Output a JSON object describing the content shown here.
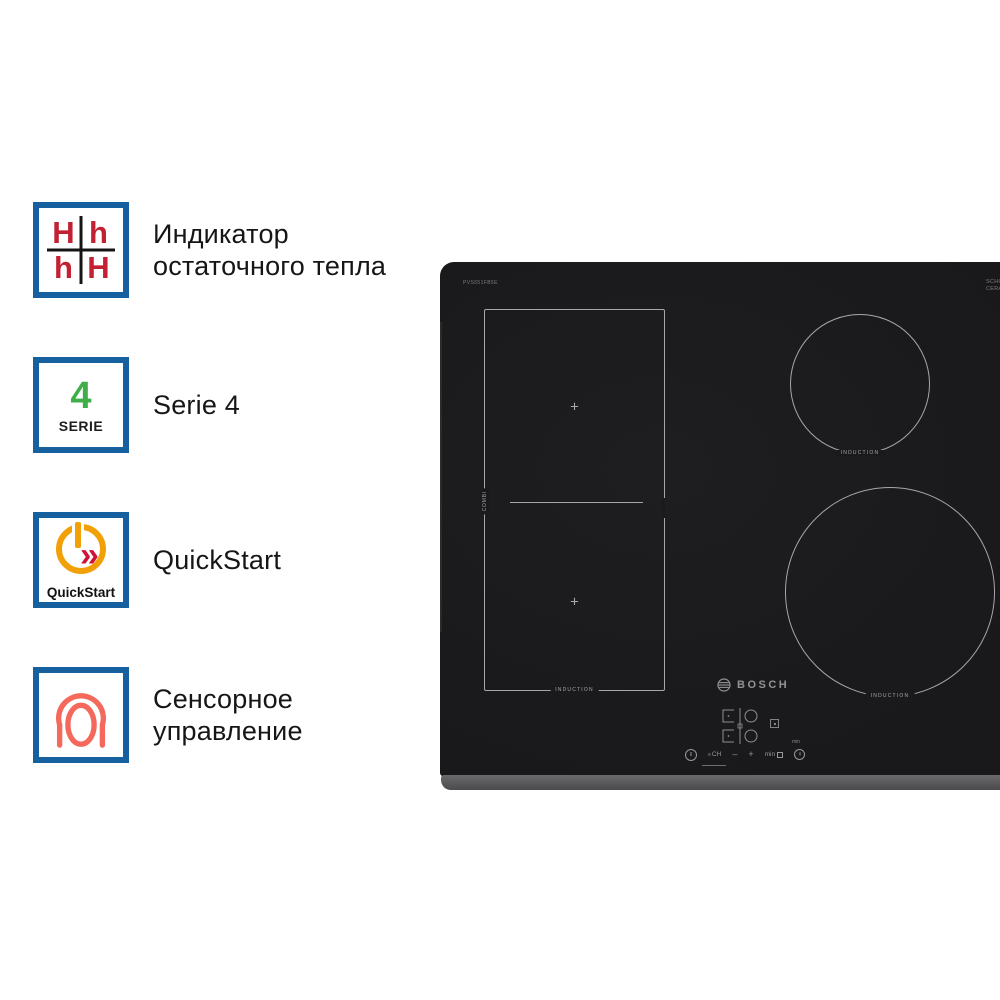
{
  "features": [
    {
      "name": "residual-heat-indicator",
      "icon": {
        "letters": [
          "H",
          "h",
          "h",
          "H"
        ]
      },
      "lines": [
        "Индикатор",
        "остаточного тепла"
      ]
    },
    {
      "name": "serie-4",
      "icon": {
        "number": "4",
        "caption": "SERIE"
      },
      "lines": [
        "Serie 4"
      ]
    },
    {
      "name": "quickstart",
      "icon": {
        "caption": "QuickStart",
        "chevrons": "»"
      },
      "lines": [
        "QuickStart"
      ]
    },
    {
      "name": "touch-control",
      "icon": {},
      "lines": [
        "Сенсорное",
        "управление"
      ]
    }
  ],
  "cooktop": {
    "brand": "BOSCH",
    "model_label": "PVS651FB5E",
    "glass_brand_lines": [
      "SCHOTT",
      "CERAN"
    ],
    "induction_label": "INDUCTION",
    "combi_label": "COMBI",
    "zone_marker": "+",
    "controls": {
      "ch": "CH",
      "bars": "≡",
      "minus": "–",
      "plus": "+",
      "timer": "min",
      "min_caption": "min"
    }
  },
  "colors": {
    "badge_border": "#1660a0",
    "letter_red": "#c42033",
    "serie_green": "#3fae49",
    "quickstart_orange": "#f2a007",
    "chevron_red": "#cf1237",
    "touch_coral": "#f4695c",
    "glass_black": "#1a1a1c",
    "bevel_gray": "#555557",
    "zone_line": "#c0c0c3"
  }
}
